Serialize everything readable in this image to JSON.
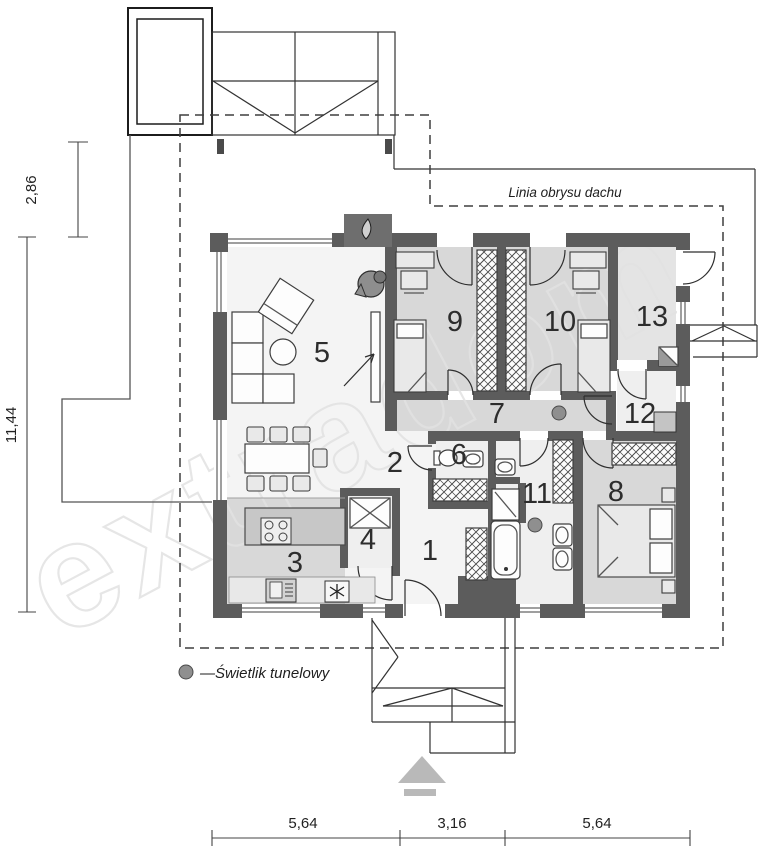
{
  "watermark": "extradom",
  "roof_outline_label": "Linia obrysu dachu",
  "legend": {
    "skylight": "—Świetlik tunelowy"
  },
  "rooms": [
    {
      "number": "1"
    },
    {
      "number": "2"
    },
    {
      "number": "3"
    },
    {
      "number": "4"
    },
    {
      "number": "5"
    },
    {
      "number": "6"
    },
    {
      "number": "7"
    },
    {
      "number": "8"
    },
    {
      "number": "9"
    },
    {
      "number": "10"
    },
    {
      "number": "11"
    },
    {
      "number": "12"
    },
    {
      "number": "13"
    }
  ],
  "dimensions": {
    "left_upper": "2,86",
    "left_lower": "11,44",
    "bottom": [
      "5,64",
      "3,16",
      "5,64"
    ]
  },
  "colors": {
    "wall": "#5c5c5c",
    "room_gray": "#d8d8d8",
    "room_mid": "#e4e4e4",
    "room_light": "#f4f4f4",
    "skylight_dot": "#8f8f8f",
    "watermark": "#e2e2e2"
  }
}
